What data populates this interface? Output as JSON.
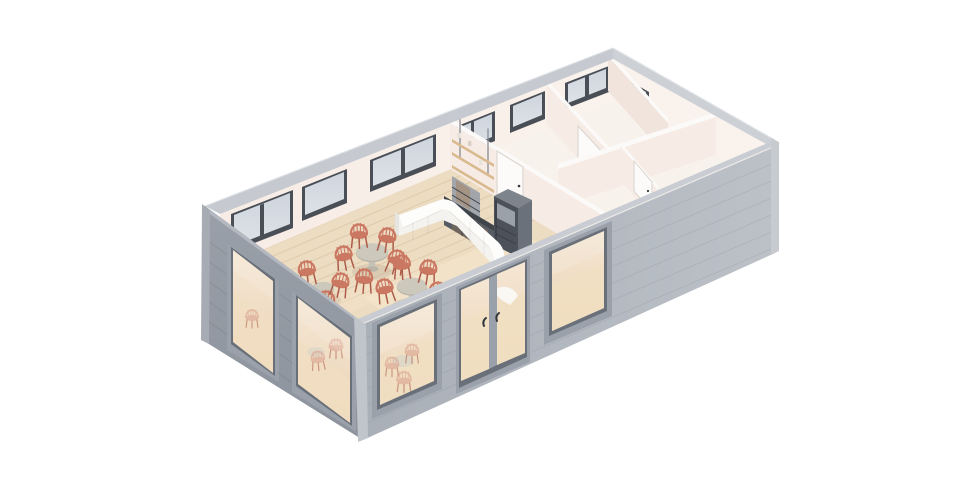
{
  "scene": {
    "type": "isometric-3d-floorplan-render",
    "subject": "Small cafe building, roof removed cutaway view",
    "areas": [
      "cafe-seating-area",
      "service-counter",
      "kitchenette",
      "back-room-left",
      "back-room-right",
      "storage-strip-rooms"
    ],
    "furniture": {
      "round_tables": 3,
      "coral_chairs": 14,
      "service_counter": 1,
      "kitchen_cabinet_unit": 1,
      "tall_fridge_unit": 1,
      "wall_shelves": 3
    },
    "openings": {
      "storefront_windows_sw": 2,
      "storefront_windows_se": 2,
      "storefront_double_door": 1,
      "clerestory_windows_back_wall": 6,
      "end_wall_window": 1,
      "interior_doors": 3
    }
  },
  "colors": {
    "bg": "#ffffff",
    "ext_sw_a": "#9aa0a9",
    "ext_sw_b": "#8d939c",
    "ext_se_a": "#a9afb7",
    "ext_se_b": "#bcc1c8",
    "band_nw": "#c6cad0",
    "band_ne": "#cdd1d6",
    "band_se": "#c9cdd3",
    "band_sw": "#b4b9c1",
    "corner_w": "#a7acb4",
    "corner_s": "#c0c5cb",
    "corner_e": "#c7cbd0",
    "frame_ext": "#9aa1aa",
    "frame_ext_dark": "#697079",
    "frame_int": "#4a4f57",
    "glass_cool_a": "#cfd5dd",
    "glass_cool_b": "#dde2e8",
    "glass_warm_a": "#f5e7d4",
    "glass_warm_b": "#ebd3b6",
    "glass_floor": "#f1dfc2",
    "int_wall": "#f7ece5",
    "int_wall_lt": "#faf2ec",
    "int_wall_sh": "#f0e4dd",
    "wall_top": "#fbfaf8",
    "floor_wood": "#ecdcc1",
    "floor_sun": "#f7e9cf",
    "plank": "rgba(153,112,70,0.16)",
    "floor_back": "#f8f2ec",
    "counter": "#fdfdfc",
    "counter_face": "#f4f3f0",
    "counter_sh": "#e7e5e1",
    "kit_dark": "#40454c",
    "kit_mid": "#555b63",
    "kit_glass": "#9aa0a8",
    "kit_amber": "#a97f52",
    "fridge_front": "#4c525a",
    "fridge_side": "#6b717a",
    "fridge_top": "#7e848c",
    "fridge_panel": "#9ba1a9",
    "shelf": "#d9b98e",
    "rod": "#878c93",
    "door_leaf": "#fcfbfa",
    "door_frame": "#ddd7d1",
    "handle": "#34383e",
    "chair": "#cb7863",
    "chair_dark": "#ad5c49",
    "chair_faint": "#d79b89",
    "table_top": "#ccc8bc",
    "table_rim": "#b8b4a8",
    "table_base": "#c7c2b6",
    "shadow": "rgba(70,60,45,0.10)",
    "siding_se": "rgba(80,90,100,0.10)",
    "siding_sw": "rgba(40,48,58,0.10)"
  }
}
